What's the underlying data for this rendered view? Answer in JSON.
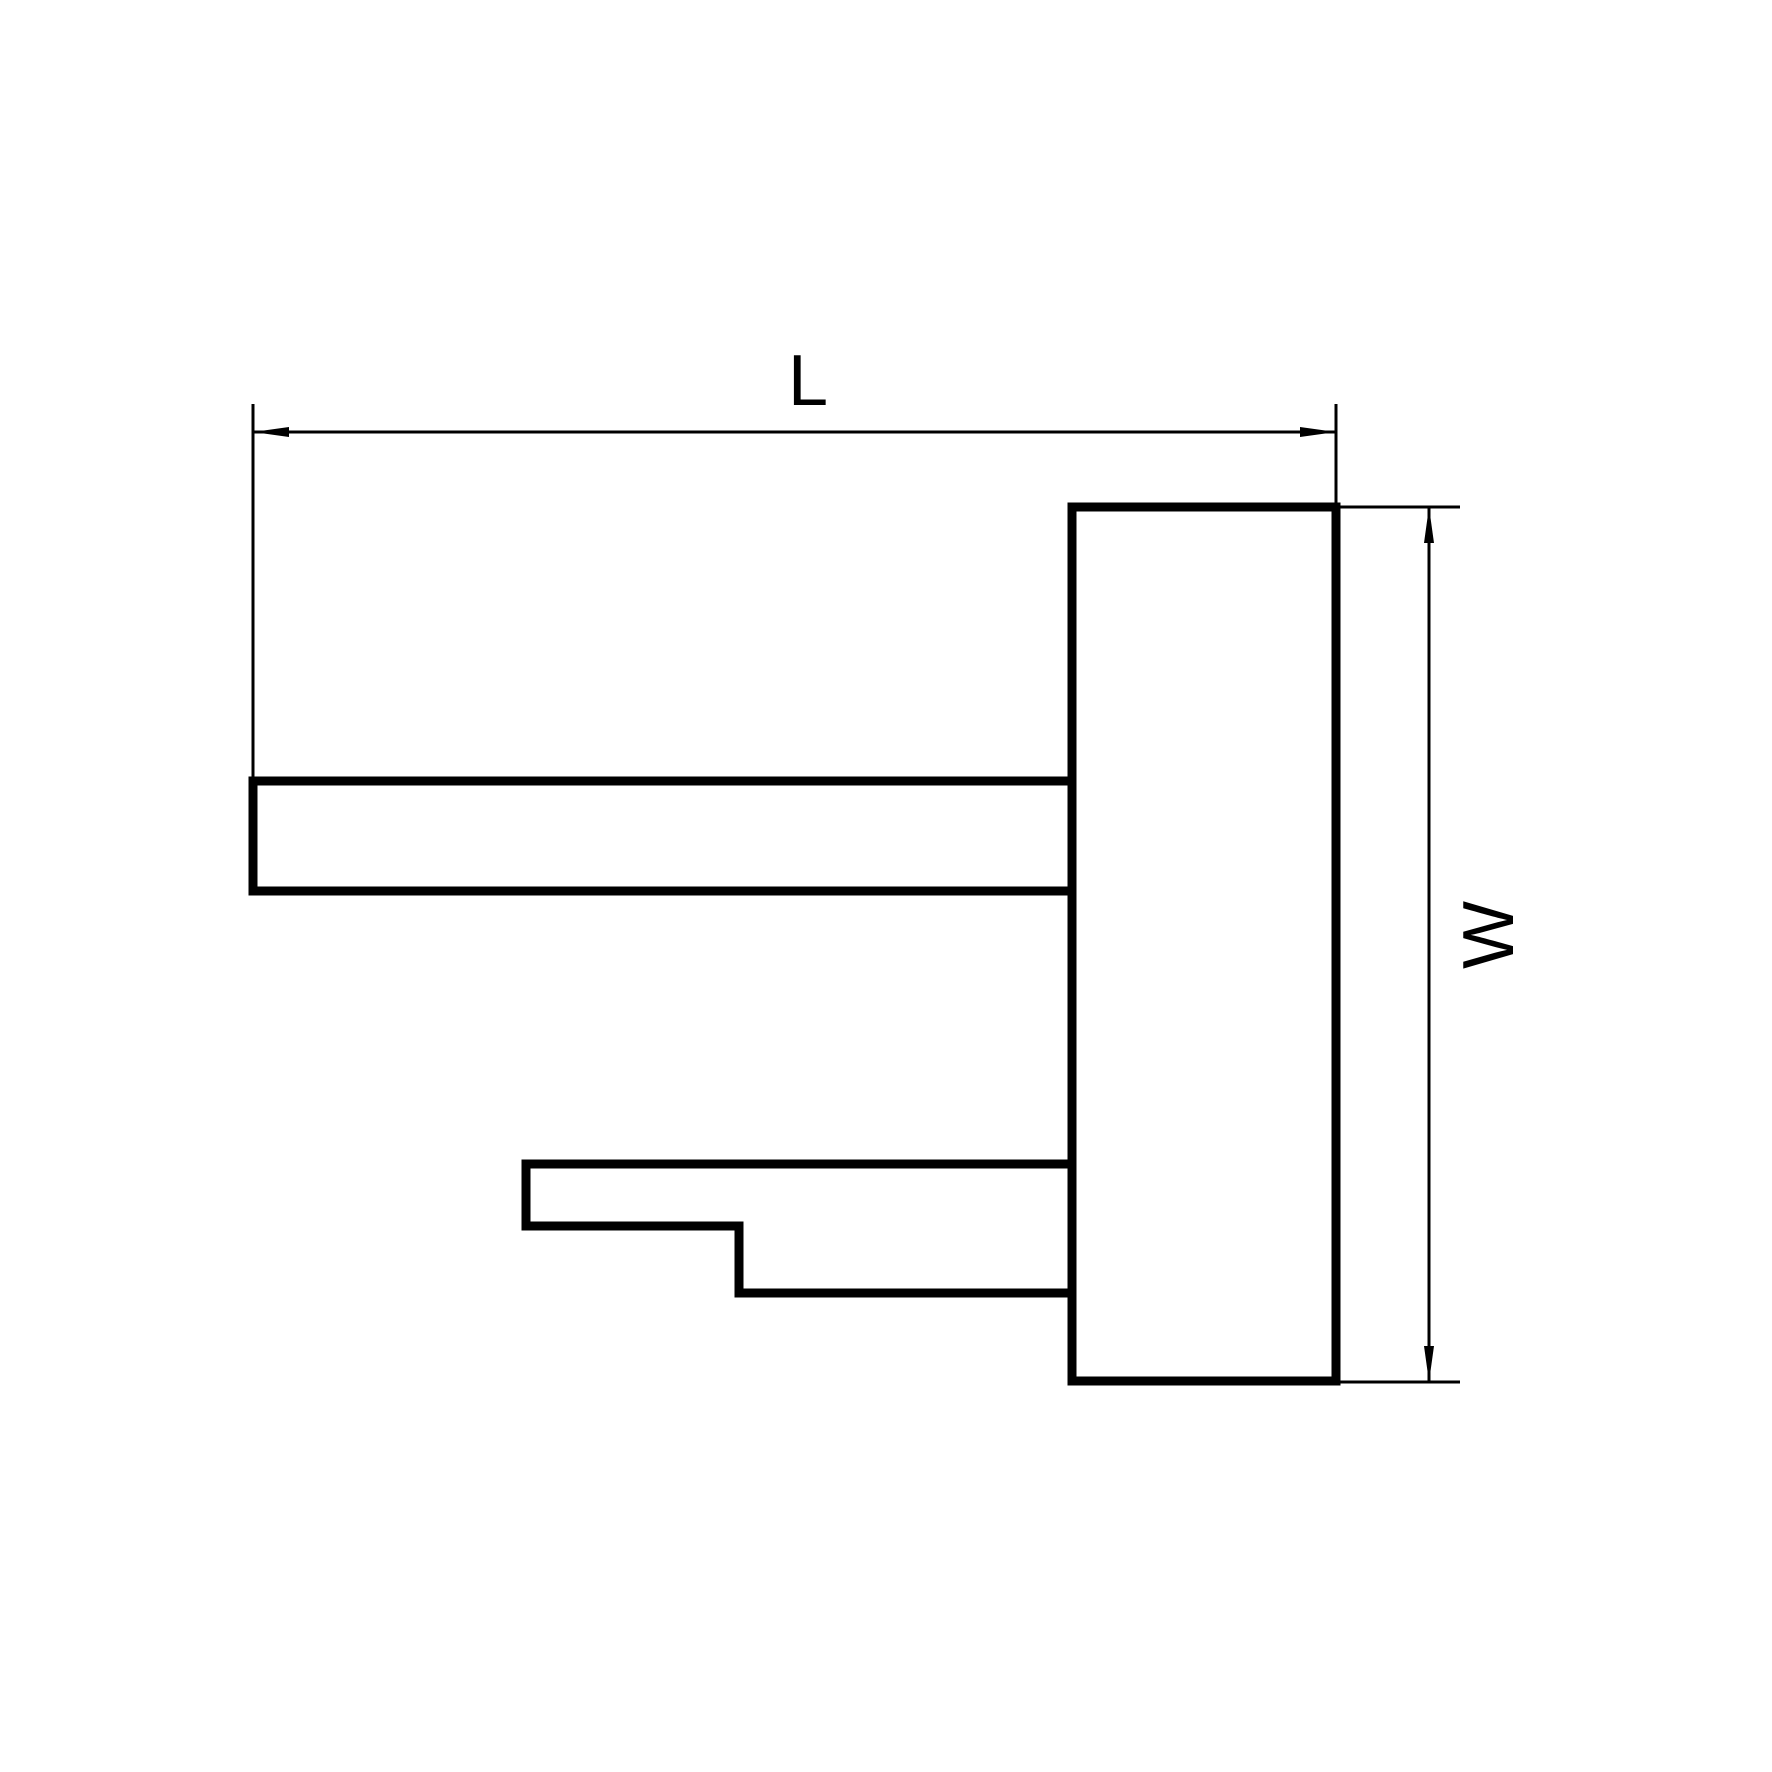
{
  "canvas": {
    "width": 1772,
    "height": 1772,
    "background_color": "#ffffff",
    "line_color": "#000000"
  },
  "labels": {
    "length_dimension": "L",
    "width_dimension": "W"
  },
  "drawing": {
    "stroke": {
      "outline_px": 9,
      "dimension_px": 3
    },
    "outline": {
      "body_rect": {
        "d": "M 1072 507 H 1336 V 1381 H 1072 Z"
      },
      "upper_arm": {
        "d": "M 1072 781 H 253 V 891 H 1072"
      },
      "stepped_arm": {
        "d": "M 1072 1164 H 526 V 1226 H 739 V 1293 H 1072"
      }
    },
    "length_dim": {
      "extension_left": {
        "d": "M 253 404 V 779"
      },
      "extension_right": {
        "d": "M 1336 404 V 505"
      },
      "line": {
        "d": "M 253 432 H 1336"
      },
      "arrow_left": {
        "points": "253,432 289,427 289,437"
      },
      "arrow_right": {
        "points": "1336,432 1300,427 1300,437"
      }
    },
    "width_dim": {
      "extension_top": {
        "d": "M 1338 507 H 1460"
      },
      "extension_bottom": {
        "d": "M 1338 1382 H 1460"
      },
      "line": {
        "d": "M 1429 507 V 1382"
      },
      "arrow_top": {
        "points": "1429,507 1424,543 1434,543"
      },
      "arrow_bottom": {
        "points": "1429,1382 1424,1346 1434,1346"
      }
    }
  }
}
